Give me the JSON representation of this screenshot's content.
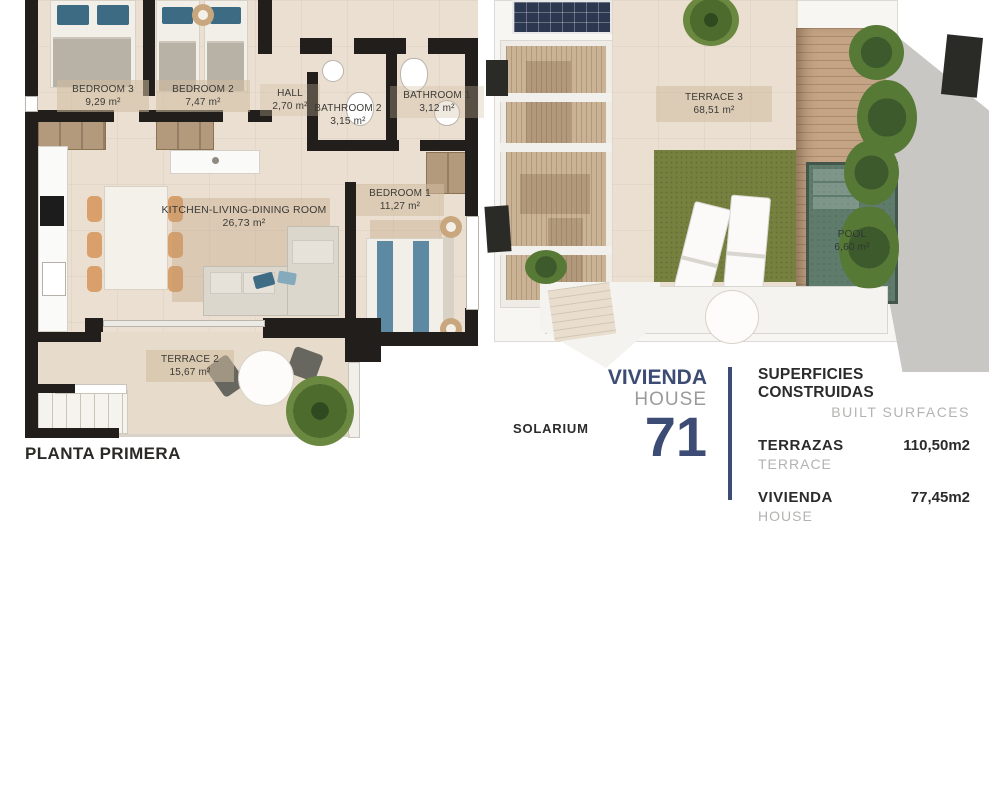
{
  "plans": {
    "first_floor": {
      "caption": "PLANTA PRIMERA",
      "rooms": [
        {
          "name": "BEDROOM 3",
          "area": "9,29 m²"
        },
        {
          "name": "BEDROOM 2",
          "area": "7,47 m²"
        },
        {
          "name": "HALL",
          "area": "2,70  m²"
        },
        {
          "name": "BATHROOM 2",
          "area": "3,15 m²"
        },
        {
          "name": "BATHROOM 1",
          "area": "3,12 m²"
        },
        {
          "name": "BEDROOM 1",
          "area": "11,27 m²"
        },
        {
          "name": "KITCHEN-LIVING-DINING ROOM",
          "area": "26,73 m²"
        },
        {
          "name": "TERRACE 2",
          "area": "15,67 m²"
        }
      ]
    },
    "solarium": {
      "caption": "SOLARIUM",
      "rooms": [
        {
          "name": "TERRACE 3",
          "area": "68,51 m²"
        },
        {
          "name": "POOL",
          "area": "6,60 m²"
        }
      ]
    }
  },
  "info_panel": {
    "house_label_es": "VIVIENDA",
    "house_label_en": "HOUSE",
    "house_number": "71",
    "surfaces_title_es": "SUPERFICIES CONSTRUIDAS",
    "surfaces_title_en": "BUILT SURFACES",
    "rows": [
      {
        "label_es": "TERRAZAS",
        "label_en": "TERRACE",
        "value": "110,50m2"
      },
      {
        "label_es": "VIVIENDA",
        "label_en": "HOUSE",
        "value": "77,45m2"
      }
    ]
  },
  "colors": {
    "accent_navy": "#3c4c74",
    "muted_gray": "#9b9b9a",
    "text_dark": "#2b2b2b",
    "wall_black": "#211e1b",
    "floor_beige": "#eadfd0",
    "grass_green": "#76813f",
    "pool_green": "#5e7b6c",
    "deck_wood": "#c4a484"
  }
}
